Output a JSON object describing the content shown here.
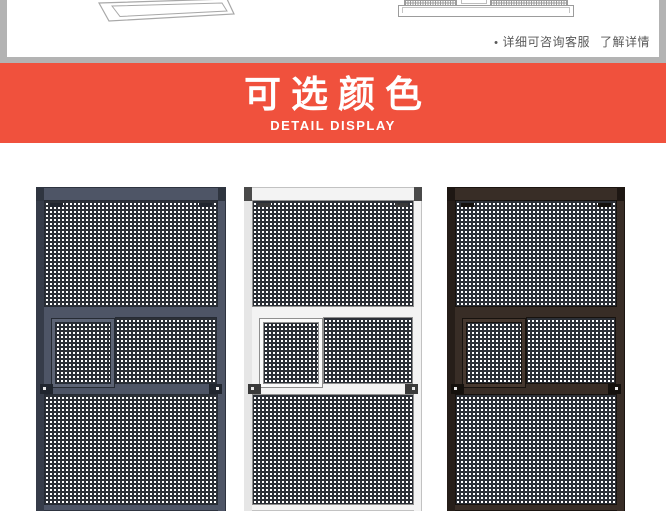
{
  "top_section": {
    "frame_color": "#b3b3b3",
    "note": {
      "bullet": "•",
      "text": "详细可咨询客服",
      "more": "了解详情"
    }
  },
  "banner": {
    "title": "可选颜色",
    "subtitle": "DETAIL DISPLAY",
    "background": "#f0513d",
    "text_color": "#ffffff"
  },
  "color_options": {
    "mesh": {
      "line": "#2b2f36",
      "background": "#ffffff"
    },
    "doors": [
      {
        "variant": "dark-gray",
        "colors": {
          "frame": "#4e5566",
          "rail": "#363c49",
          "edge": "#262b34",
          "panel": "#5d6475",
          "latch": "#20252e",
          "corner": "#2f3540",
          "outline": "#2e3440"
        }
      },
      {
        "variant": "white",
        "colors": {
          "frame": "#f3f3f3",
          "rail": "#e6e6e6",
          "edge": "#8f8f8f",
          "panel": "#fbfbfb",
          "latch": "#3a3a3a",
          "corner": "#4a4a4a",
          "outline": "#c2c2c2"
        }
      },
      {
        "variant": "dark-brown",
        "colors": {
          "frame": "#382d26",
          "rail": "#261e19",
          "edge": "#17120e",
          "panel": "#46382f",
          "latch": "#14100c",
          "corner": "#1e1713",
          "outline": "#1b1511"
        }
      }
    ]
  }
}
